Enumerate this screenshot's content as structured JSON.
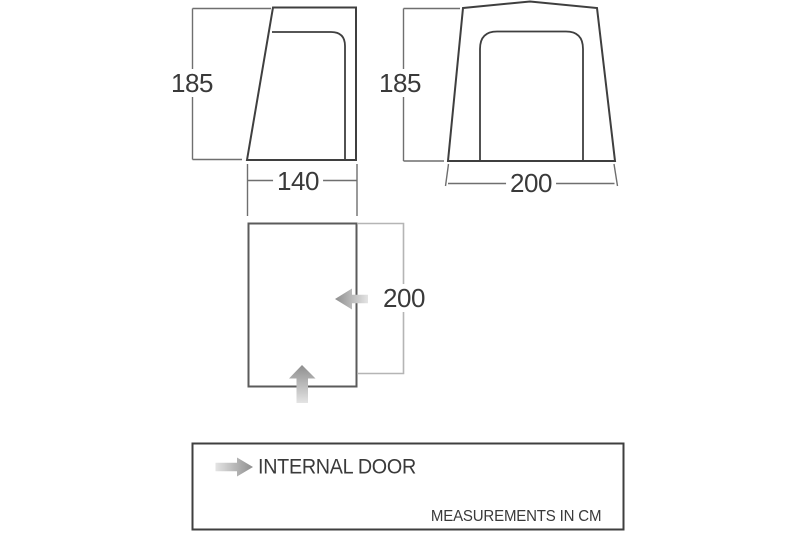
{
  "diagram": {
    "side_view": {
      "height_label": "185",
      "width_label": "140"
    },
    "front_view": {
      "height_label": "185",
      "width_label": "200"
    },
    "floorplan": {
      "depth_label": "200"
    },
    "legend": {
      "door_label": "INTERNAL DOOR",
      "units_note": "MEASUREMENTS IN CM"
    },
    "icons": {
      "legend_arrow": "right-arrow-icon",
      "floorplan_side_door_arrow": "left-arrow-icon",
      "floorplan_front_door_arrow": "up-arrow-icon"
    },
    "colors": {
      "outline": "#3f3f3f",
      "plan_outline": "#5b5b5b",
      "dimension": "#6f6f6f",
      "bracket": "#b5b5b5",
      "arrow": "#8e8e8e",
      "arrow_fade": "#e4e4e4",
      "text": "#3a3a3a"
    }
  }
}
